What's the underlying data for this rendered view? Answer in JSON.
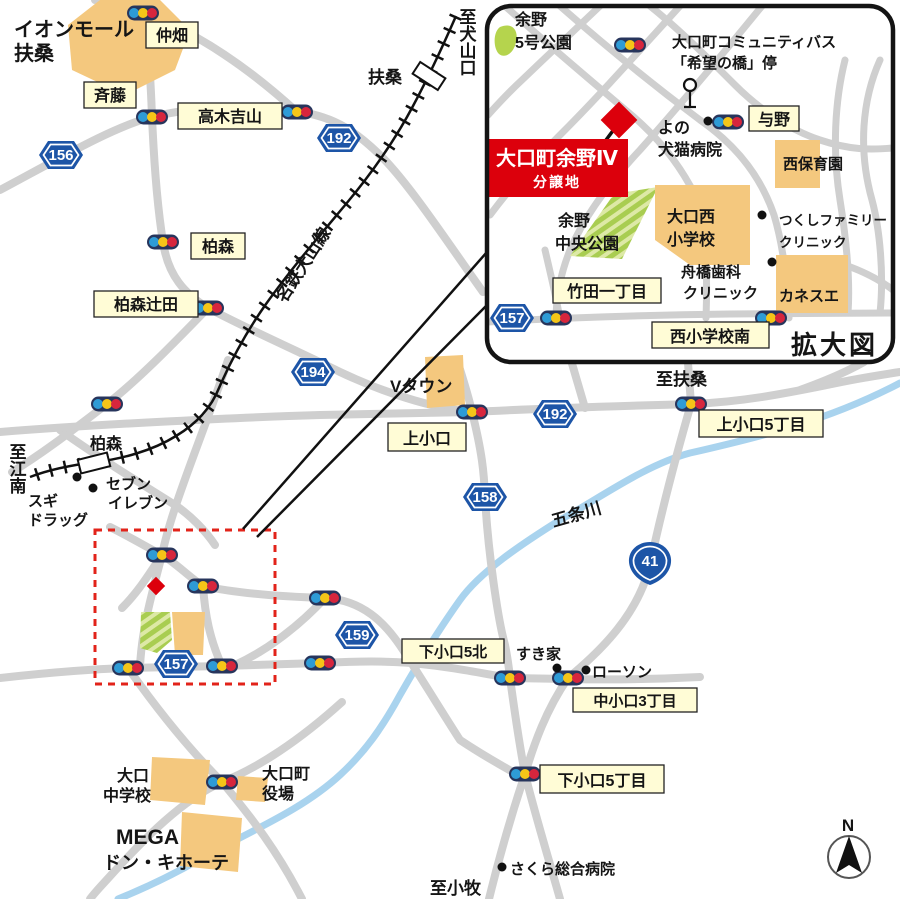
{
  "palette": {
    "road": "#cfcfcf",
    "river": "#a9d3ee",
    "rail": "#111111",
    "building": "#f4c87e",
    "park_green": "#b5d44d",
    "park_stripe": "#dde9a6",
    "label_bg": "#fffcd6",
    "label_border": "#222222",
    "shield_blue": "#1d55a7",
    "site_red": "#dc000c",
    "dashed_red": "#e2231a",
    "signal_blue": "#2e9bd6",
    "signal_yellow": "#f5c518",
    "signal_red": "#d7263d"
  },
  "site": {
    "line1": "大口町余野Ⅳ",
    "line2": "分譲地"
  },
  "inset": {
    "caption": "拡大図",
    "yono_park_l1": "余野",
    "yono_park_l2": "5号公園",
    "combus_l1": "大口町コミュニティバス",
    "combus_l2": "「希望の橋」停",
    "yono_hosp_l1": "よの",
    "yono_hosp_l2": "犬猫病院",
    "yono_badge": "与野",
    "nishi_hoikuen": "西保育園",
    "tsukushi_l1": "つくしファミリー",
    "tsukushi_l2": "クリニック",
    "oguchi_nishi_l1": "大口西",
    "oguchi_nishi_l2": "小学校",
    "yono_chuo_l1": "余野",
    "yono_chuo_l2": "中央公園",
    "funahashi_l1": "舟橋歯科",
    "funahashi_l2": "クリニック",
    "kanesue": "カネスエ",
    "takeda": "竹田一丁目",
    "nishi_minami": "西小学校南"
  },
  "routes": {
    "r156": "156",
    "r192": "192",
    "r194": "194",
    "r158": "158",
    "r159": "159",
    "r157": "157",
    "r41": "41"
  },
  "areas": {
    "nakahata": "仲畑",
    "saito": "斉藤",
    "takagi": "高木吉山",
    "kashiwamori": "柏森",
    "tsujita": "柏森辻田",
    "kamioguchi": "上小口",
    "kamioguchi5": "上小口5丁目",
    "shimo5kita": "下小口5北",
    "nakaoguchi3": "中小口3丁目",
    "shimo5": "下小口5丁目"
  },
  "places": {
    "aeon_l1": "イオンモール",
    "aeon_l2": "扶桑",
    "vtown": "Vタウン",
    "sugi_l1": "スギ",
    "sugi_l2": "ドラッグ",
    "seven_l1": "セブン",
    "seven_l2": "イレブン",
    "sukiya": "すき家",
    "lawson": "ローソン",
    "sakura": "さくら総合病院",
    "chugaku_l1": "大口",
    "chugaku_l2": "中学校",
    "yakuba_l1": "大口町",
    "yakuba_l2": "役場",
    "mega_l1": "MEGA",
    "mega_l2": "ドン・キホーテ"
  },
  "stations": {
    "fuso": "扶桑",
    "kashiwamori": "柏森"
  },
  "lines": {
    "rail": "名鉄犬山線",
    "river": "五条川"
  },
  "directions": {
    "inuyamaguchi": "至犬山口",
    "konan": "至江南",
    "fuso": "至扶桑",
    "komaki": "至小牧"
  },
  "compass": {
    "north": "N"
  }
}
